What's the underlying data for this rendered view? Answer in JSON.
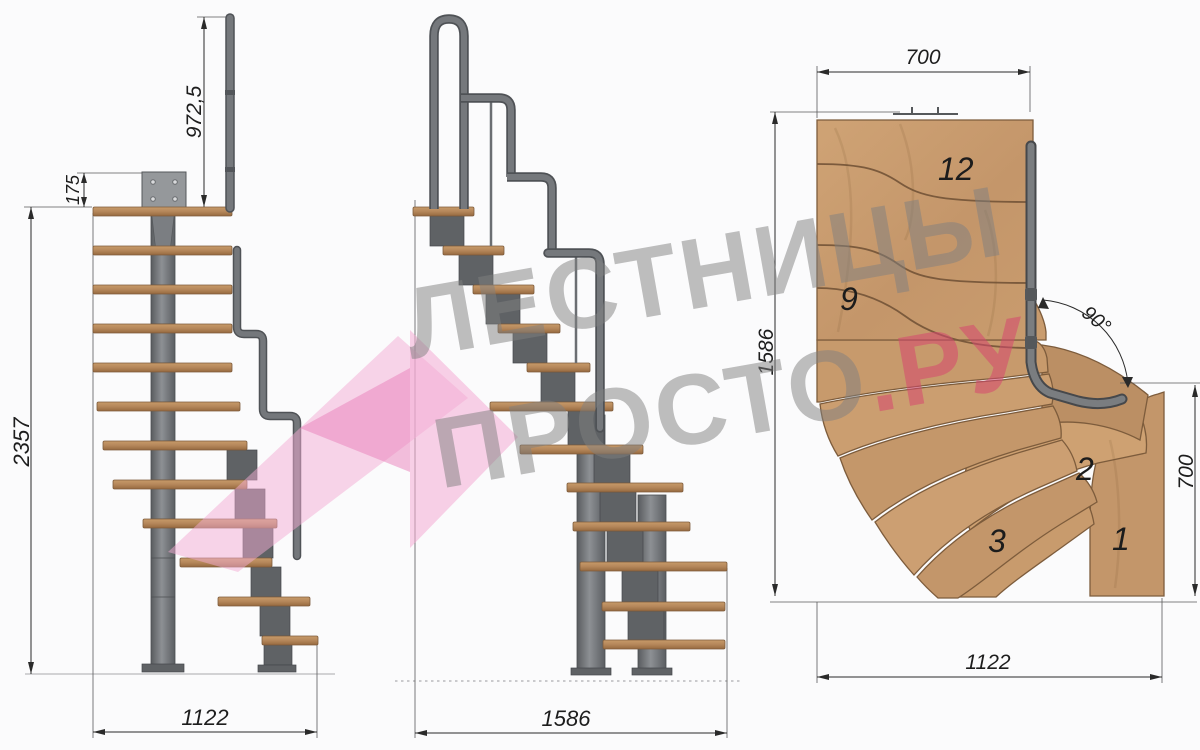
{
  "watermark": {
    "line1": "ЛЕСТНИЦЫ",
    "line2_gray": "ПРОСТО",
    "line2_pink": ".РУ",
    "gray_color": "#808080",
    "pink_color": "#d6486f",
    "arrow_pink": "#f4abd3"
  },
  "side_view_a": {
    "dim_total_height": "2357",
    "dim_plate_offset": "175",
    "dim_handrail_height": "972,5",
    "dim_width": "1122"
  },
  "side_view_b": {
    "dim_width": "1586"
  },
  "plan_view": {
    "dim_top_width": "700",
    "dim_left_depth": "1586",
    "dim_right_depth": "700",
    "dim_bottom_width": "1122",
    "dim_turn_angle": "90°",
    "step_labels": {
      "s12": "12",
      "s9": "9",
      "s3": "3",
      "s2": "2",
      "s1": "1"
    }
  },
  "colors": {
    "wood_side": "#b98a5c",
    "wood_plan": "#c99c6e",
    "metal": "#6f7276",
    "dim_line": "#2a2a2a"
  }
}
